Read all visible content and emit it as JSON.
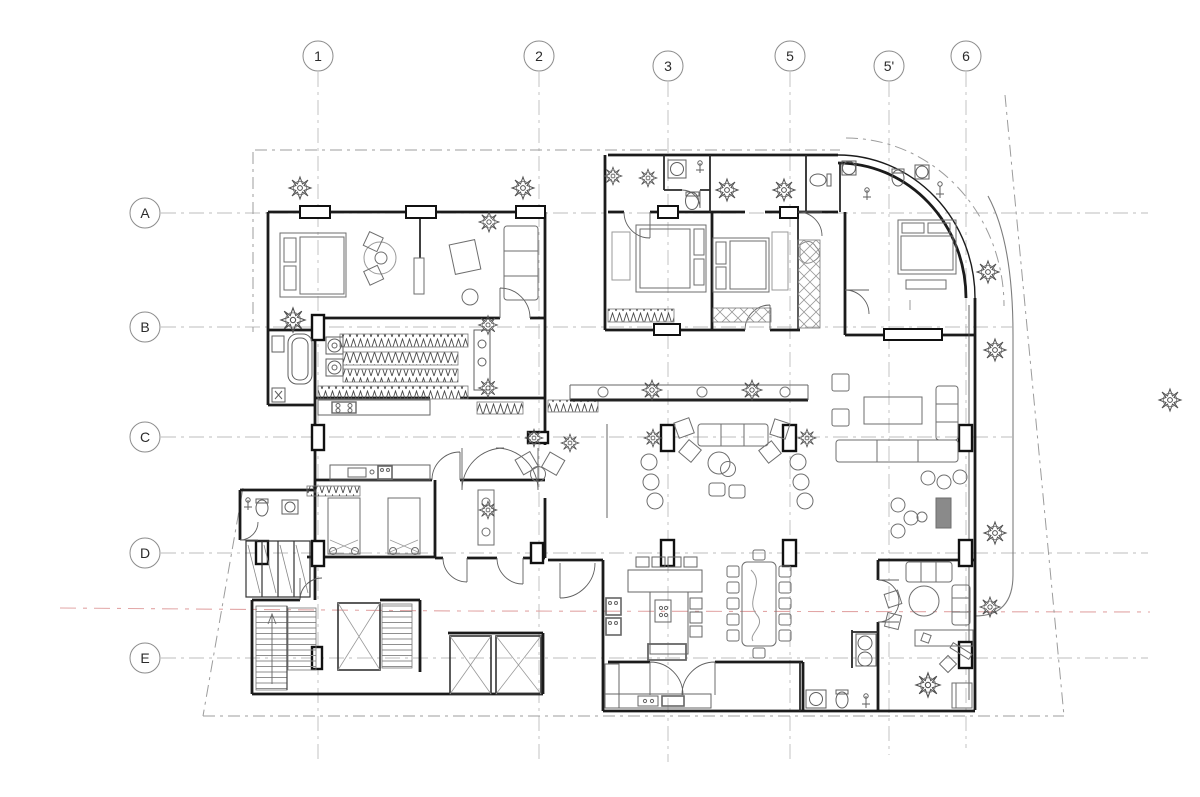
{
  "drawing": {
    "description": "architectural floor plan",
    "grid": {
      "bubble_radius": 15,
      "columns": [
        {
          "label": "1"
        },
        {
          "label": "2"
        },
        {
          "label": "3"
        },
        {
          "label": "5"
        },
        {
          "label": "5'"
        },
        {
          "label": "6"
        }
      ],
      "rows": [
        {
          "label": "A"
        },
        {
          "label": "B"
        },
        {
          "label": "C"
        },
        {
          "label": "D"
        },
        {
          "label": "E"
        }
      ]
    },
    "colors": {
      "background": "#ffffff",
      "walls": "#1b1b1b",
      "furniture": "#7a7a7a",
      "fixtures": "#5f5f5f",
      "grid_lines": "#bdbdbd",
      "centerline_red": "#e2a6a6",
      "boundary": "#9c9c9c",
      "hatch": "#a5a5a5"
    }
  }
}
